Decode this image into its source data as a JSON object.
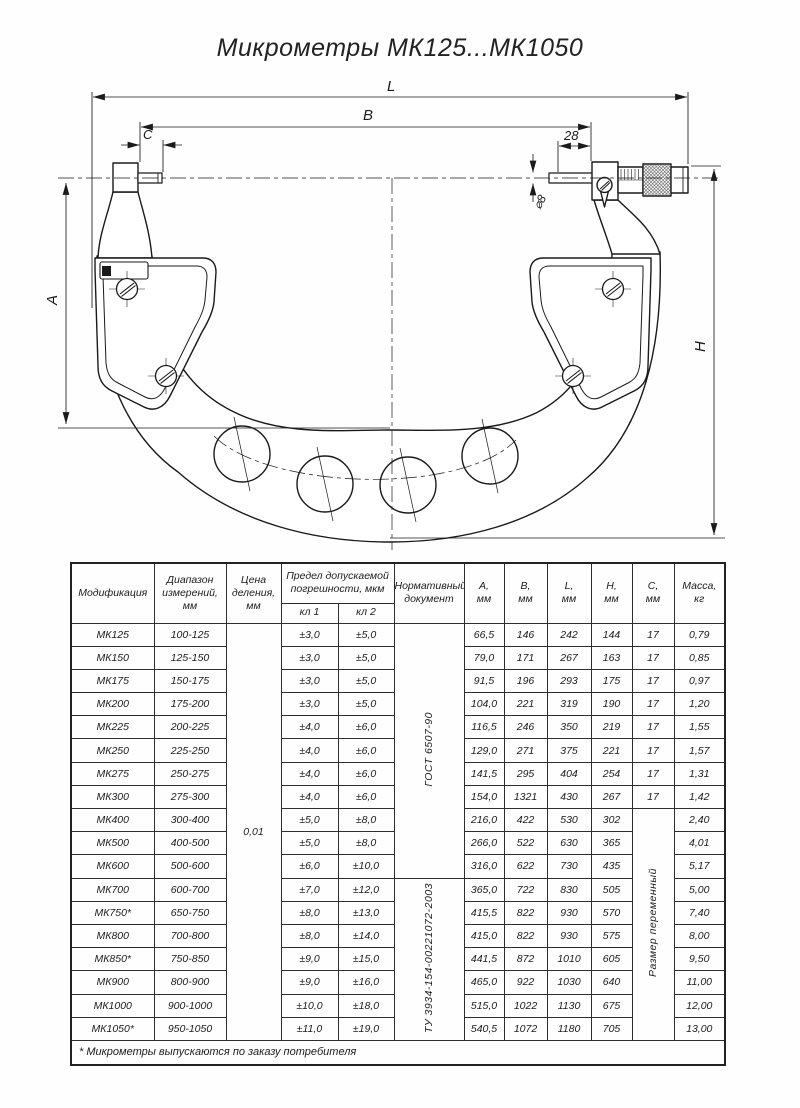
{
  "title": "Микрометры МК125...МК1050",
  "drawing": {
    "labels": {
      "l": "L",
      "b": "B",
      "c": "C",
      "offset": "28",
      "dia": "⌀8",
      "a": "A",
      "h": "H"
    }
  },
  "table": {
    "headers": {
      "modification": "Модификация",
      "range": "Диапазон\nизмерений,\nмм",
      "division": "Цена\nделения,\nмм",
      "error_limit": "Предел допускаемой\nпогрешности, мкм",
      "class1": "кл 1",
      "class2": "кл 2",
      "normative": "Нормативный\nдокумент",
      "a": "А,\nмм",
      "b": "В,\nмм",
      "l": "L,\nмм",
      "h": "Н,\nмм",
      "c": "С,\nмм",
      "mass": "Масса,\nкг"
    },
    "division_value": "0,01",
    "normative_documents": [
      "ГОСТ 6507-90",
      "ТУ 3934-154-00221072-2003"
    ],
    "variable_size_note": "Размер переменный",
    "footnote": "* Микрометры выпускаются по заказу потребителя",
    "rows": [
      {
        "model": "МК125",
        "range": "100-125",
        "cl1": "±3,0",
        "cl2": "±5,0",
        "a": "66,5",
        "b": "146",
        "l": "242",
        "h": "144",
        "c": "17",
        "mass": "0,79"
      },
      {
        "model": "МК150",
        "range": "125-150",
        "cl1": "±3,0",
        "cl2": "±5,0",
        "a": "79,0",
        "b": "171",
        "l": "267",
        "h": "163",
        "c": "17",
        "mass": "0,85"
      },
      {
        "model": "МК175",
        "range": "150-175",
        "cl1": "±3,0",
        "cl2": "±5,0",
        "a": "91,5",
        "b": "196",
        "l": "293",
        "h": "175",
        "c": "17",
        "mass": "0,97"
      },
      {
        "model": "МК200",
        "range": "175-200",
        "cl1": "±3,0",
        "cl2": "±5,0",
        "a": "104,0",
        "b": "221",
        "l": "319",
        "h": "190",
        "c": "17",
        "mass": "1,20"
      },
      {
        "model": "МК225",
        "range": "200-225",
        "cl1": "±4,0",
        "cl2": "±6,0",
        "a": "116,5",
        "b": "246",
        "l": "350",
        "h": "219",
        "c": "17",
        "mass": "1,55"
      },
      {
        "model": "МК250",
        "range": "225-250",
        "cl1": "±4,0",
        "cl2": "±6,0",
        "a": "129,0",
        "b": "271",
        "l": "375",
        "h": "221",
        "c": "17",
        "mass": "1,57"
      },
      {
        "model": "МК275",
        "range": "250-275",
        "cl1": "±4,0",
        "cl2": "±6,0",
        "a": "141,5",
        "b": "295",
        "l": "404",
        "h": "254",
        "c": "17",
        "mass": "1,31"
      },
      {
        "model": "МК300",
        "range": "275-300",
        "cl1": "±4,0",
        "cl2": "±6,0",
        "a": "154,0",
        "b": "1321",
        "l": "430",
        "h": "267",
        "c": "17",
        "mass": "1,42"
      },
      {
        "model": "МК400",
        "range": "300-400",
        "cl1": "±5,0",
        "cl2": "±8,0",
        "a": "216,0",
        "b": "422",
        "l": "530",
        "h": "302",
        "mass": "2,40"
      },
      {
        "model": "МК500",
        "range": "400-500",
        "cl1": "±5,0",
        "cl2": "±8,0",
        "a": "266,0",
        "b": "522",
        "l": "630",
        "h": "365",
        "mass": "4,01"
      },
      {
        "model": "МК600",
        "range": "500-600",
        "cl1": "±6,0",
        "cl2": "±10,0",
        "a": "316,0",
        "b": "622",
        "l": "730",
        "h": "435",
        "mass": "5,17"
      },
      {
        "model": "МК700",
        "range": "600-700",
        "cl1": "±7,0",
        "cl2": "±12,0",
        "a": "365,0",
        "b": "722",
        "l": "830",
        "h": "505",
        "mass": "5,00"
      },
      {
        "model": "МК750*",
        "range": "650-750",
        "cl1": "±8,0",
        "cl2": "±13,0",
        "a": "415,5",
        "b": "822",
        "l": "930",
        "h": "570",
        "mass": "7,40"
      },
      {
        "model": "МК800",
        "range": "700-800",
        "cl1": "±8,0",
        "cl2": "±14,0",
        "a": "415,0",
        "b": "822",
        "l": "930",
        "h": "575",
        "mass": "8,00"
      },
      {
        "model": "МК850*",
        "range": "750-850",
        "cl1": "±9,0",
        "cl2": "±15,0",
        "a": "441,5",
        "b": "872",
        "l": "1010",
        "h": "605",
        "mass": "9,50"
      },
      {
        "model": "МК900",
        "range": "800-900",
        "cl1": "±9,0",
        "cl2": "±16,0",
        "a": "465,0",
        "b": "922",
        "l": "1030",
        "h": "640",
        "mass": "11,00"
      },
      {
        "model": "МК1000",
        "range": "900-1000",
        "cl1": "±10,0",
        "cl2": "±18,0",
        "a": "515,0",
        "b": "1022",
        "l": "1130",
        "h": "675",
        "mass": "12,00"
      },
      {
        "model": "МК1050*",
        "range": "950-1050",
        "cl1": "±11,0",
        "cl2": "±19,0",
        "a": "540,5",
        "b": "1072",
        "l": "1180",
        "h": "705",
        "mass": "13,00"
      }
    ]
  }
}
